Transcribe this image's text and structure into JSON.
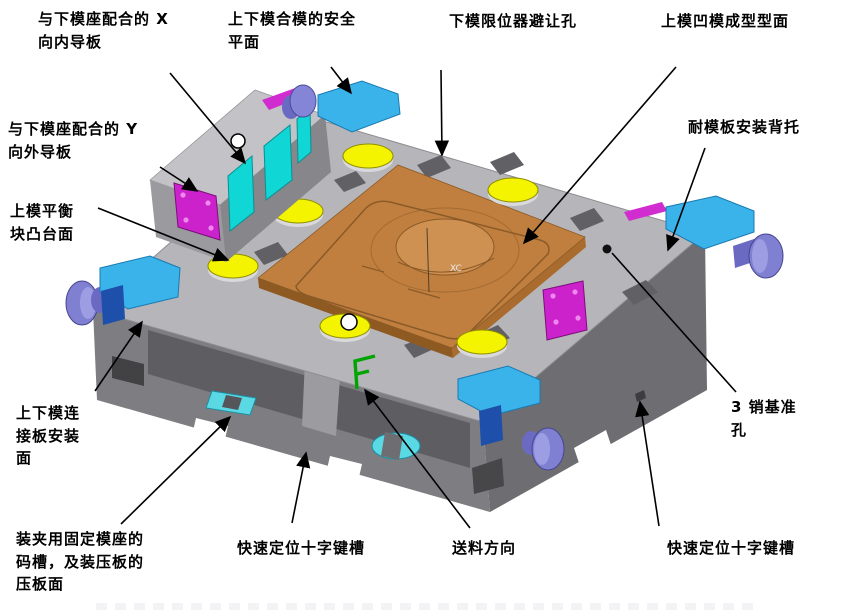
{
  "figure": {
    "type": "annotated-isometric-cad-diagram",
    "surface_axis_text": "XC",
    "feed_symbol_glyph": "F"
  },
  "palette": {
    "die_top": "#b6b6ba",
    "die_front_left": "#7e7e82",
    "die_front_right": "#6e6e72",
    "die_recess": "#5e5e62",
    "notch_dark": "#606065",
    "forming_panel_orange": "#c07f3e",
    "forming_panel_edge": "#8f5a22",
    "balance_pad_yellow": "#f4f400",
    "guide_plate_cyan": "#10d6d6",
    "corner_block_skyblue": "#3ab2ea",
    "guide_plate_magenta": "#cc22cc",
    "handle_blue": "#8080d2",
    "patch_dark_blue": "#1e4faa",
    "feed_symbol_green": "#00a400",
    "leader_line": "#000000"
  },
  "labels": [
    {
      "id": "label-x-inner-guide",
      "text": "与下模座配合的 X\n向内导板",
      "x": 38,
      "y": 8
    },
    {
      "id": "label-mold-closing-safety-plane",
      "text": "上下模合模的安全\n平面",
      "x": 228,
      "y": 8
    },
    {
      "id": "label-limiter-clearance-hole",
      "text": "下模限位器避让孔",
      "x": 449,
      "y": 10
    },
    {
      "id": "label-cavity-forming-surface",
      "text": "上模凹模成型型面",
      "x": 661,
      "y": 10
    },
    {
      "id": "label-wear-plate-backing",
      "text": "耐模板安装背托",
      "x": 688,
      "y": 116
    },
    {
      "id": "label-y-outer-guide",
      "text": "与下模座配合的 Y\n向外导板",
      "x": 8,
      "y": 118
    },
    {
      "id": "label-balance-block-boss",
      "text": "上模平衡\n块凸台面",
      "x": 10,
      "y": 200
    },
    {
      "id": "label-connection-plate-mount",
      "text": "上下模连\n接板安装\n面",
      "x": 16,
      "y": 402
    },
    {
      "id": "label-clamp-slot",
      "text": "装夹用固定模座的\n码槽，及装压板的\n压板面",
      "x": 16,
      "y": 528
    },
    {
      "id": "label-cross-keyway-left",
      "text": "快速定位十字键槽",
      "x": 237,
      "y": 537
    },
    {
      "id": "label-feed-direction",
      "text": "送料方向",
      "x": 452,
      "y": 537
    },
    {
      "id": "label-cross-keyway-right",
      "text": "快速定位十字键槽",
      "x": 667,
      "y": 537
    },
    {
      "id": "label-pin-datum-holes",
      "text": "3  销基准\n孔",
      "x": 731,
      "y": 396
    }
  ],
  "arrows": [
    {
      "target": "x-inner-guide",
      "x1": 170,
      "y1": 73,
      "x2": 245,
      "y2": 163,
      "head": true
    },
    {
      "target": "mold-closing-safety-plane",
      "x1": 331,
      "y1": 67,
      "x2": 351,
      "y2": 93,
      "head": true
    },
    {
      "target": "limiter-clearance-hole",
      "x1": 441,
      "y1": 70,
      "x2": 442,
      "y2": 155,
      "head": true
    },
    {
      "target": "cavity-forming-surface",
      "x1": 676,
      "y1": 67,
      "x2": 524,
      "y2": 243,
      "head": true
    },
    {
      "target": "wear-plate-backing",
      "x1": 705,
      "y1": 148,
      "x2": 668,
      "y2": 250,
      "head": true
    },
    {
      "target": "y-outer-guide",
      "x1": 160,
      "y1": 167,
      "x2": 197,
      "y2": 191,
      "head": true
    },
    {
      "target": "balance-block-boss",
      "x1": 98,
      "y1": 208,
      "x2": 228,
      "y2": 260,
      "head": true
    },
    {
      "target": "connection-plate-mount",
      "x1": 95,
      "y1": 391,
      "x2": 142,
      "y2": 322,
      "head": true
    },
    {
      "target": "clamp-slot",
      "x1": 121,
      "y1": 524,
      "x2": 230,
      "y2": 417,
      "head": true
    },
    {
      "target": "cross-keyway-left",
      "x1": 292,
      "y1": 523,
      "x2": 306,
      "y2": 453,
      "head": true
    },
    {
      "target": "feed-direction",
      "x1": 470,
      "y1": 528,
      "x2": 365,
      "y2": 390,
      "head": true
    },
    {
      "target": "cross-keyway-right",
      "x1": 659,
      "y1": 526,
      "x2": 640,
      "y2": 402,
      "head": true
    },
    {
      "target": "pin-datum-holes",
      "x1": 736,
      "y1": 392,
      "x2": 612,
      "y2": 253,
      "head": false
    }
  ],
  "markers": {
    "circle_marks": [
      {
        "x": 238,
        "y": 141,
        "r": 7
      },
      {
        "x": 349,
        "y": 322,
        "r": 8
      }
    ],
    "datum_dot": {
      "x": 607,
      "y": 249,
      "r": 4.5
    }
  }
}
